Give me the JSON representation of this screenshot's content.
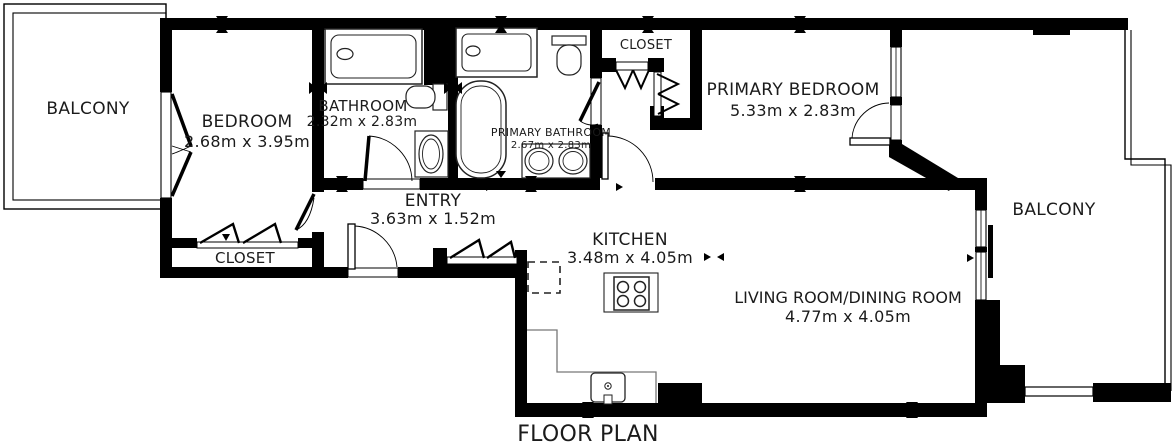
{
  "caption": "FLOOR PLAN",
  "rooms": {
    "balcony_left": {
      "name": "BALCONY"
    },
    "bedroom": {
      "name": "BEDROOM",
      "dims": "2.68m x 3.95m"
    },
    "bedroom_closet": {
      "name": "CLOSET"
    },
    "bathroom": {
      "name": "BATHROOM",
      "dims": "2.32m x 2.83m"
    },
    "entry": {
      "name": "ENTRY",
      "dims": "3.63m x 1.52m"
    },
    "primary_bathroom": {
      "name": "PRIMARY BATHROOM",
      "dims": "2.67m x 2.83m"
    },
    "primary_closet": {
      "name": "CLOSET"
    },
    "primary_bedroom": {
      "name": "PRIMARY BEDROOM",
      "dims": "5.33m x 2.83m"
    },
    "kitchen": {
      "name": "KITCHEN",
      "dims": "3.48m x 4.05m"
    },
    "living_dining": {
      "name": "LIVING ROOM/DINING ROOM",
      "dims": "4.77m x 4.05m"
    },
    "balcony_right": {
      "name": "BALCONY"
    }
  },
  "fixtures": [
    "bathtub",
    "toilet",
    "sink",
    "shower",
    "freestanding-tub",
    "double-sink-vanity",
    "cooktop",
    "kitchen-sink",
    "dashed-appliance-space",
    "bifold-doors",
    "door-swings",
    "windows",
    "sliding-door"
  ],
  "colors": {
    "wall": "#000000",
    "background": "#ffffff",
    "text": "#1b1b1b",
    "fixture_line": "#222222",
    "counter_line": "#777777"
  }
}
